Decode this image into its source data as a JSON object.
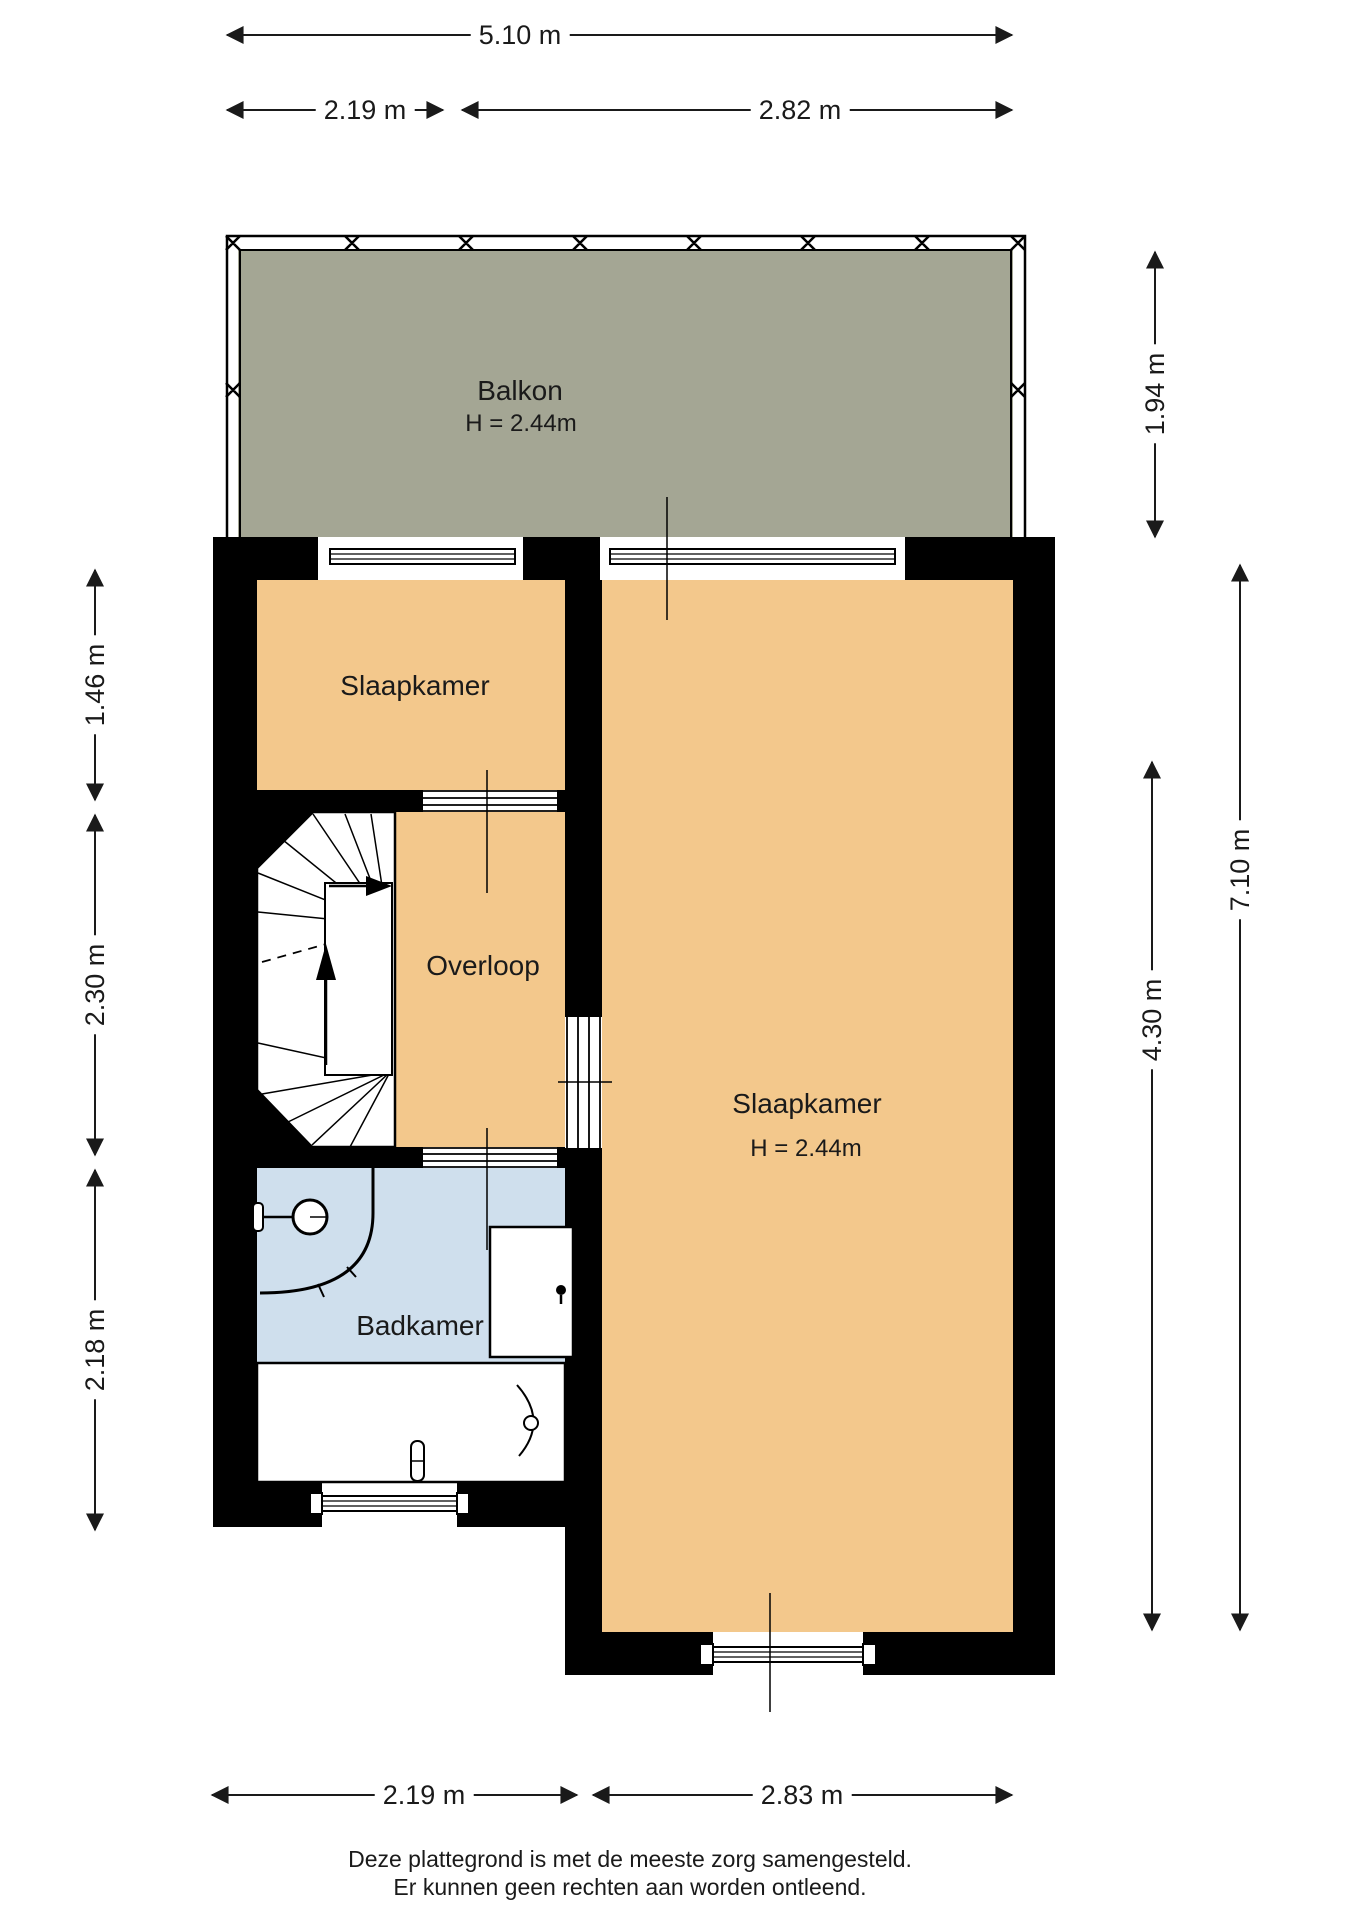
{
  "dimensions": {
    "top_total": "5.10 m",
    "top_left": "2.19 m",
    "top_right": "2.82 m",
    "left_upper": "1.46 m",
    "left_middle": "2.30 m",
    "left_lower": "2.18 m",
    "right_balcony": "1.94 m",
    "right_total": "7.10 m",
    "right_lower": "4.30 m",
    "bottom_left": "2.19 m",
    "bottom_right": "2.83 m"
  },
  "rooms": {
    "balkon": {
      "label": "Balkon",
      "height_note": "H = 2.44m"
    },
    "slaapkamer_left": {
      "label": "Slaapkamer"
    },
    "overloop": {
      "label": "Overloop"
    },
    "slaapkamer_right": {
      "label": "Slaapkamer",
      "height_note": "H = 2.44m"
    },
    "badkamer": {
      "label": "Badkamer"
    }
  },
  "footer": {
    "line1": "Deze plattegrond is met de meeste zorg samengesteld.",
    "line2": "Er kunnen geen rechten aan worden ontleend."
  },
  "colors": {
    "wall": "#000000",
    "room_fill": "#f3c88c",
    "balcony_fill": "#a4a694",
    "bathroom_fill": "#cfdfed",
    "line": "#1a1a1a",
    "background": "#ffffff"
  },
  "icons": {
    "railing-post-icon": "x-cross",
    "window-icon": "parallel-glazing-lines",
    "door-threshold-icon": "parallel-lines",
    "stairs-icon": "winder-treads-with-up-arrow",
    "shower-head-icon": "circle-with-wall-arm",
    "shower-screen-icon": "quarter-arc",
    "bathtub-icon": "rounded-rect-with-faucet",
    "door-leaf-icon": "rectangle-with-knob",
    "dimension-arrow-icon": "double-headed-arrow"
  }
}
